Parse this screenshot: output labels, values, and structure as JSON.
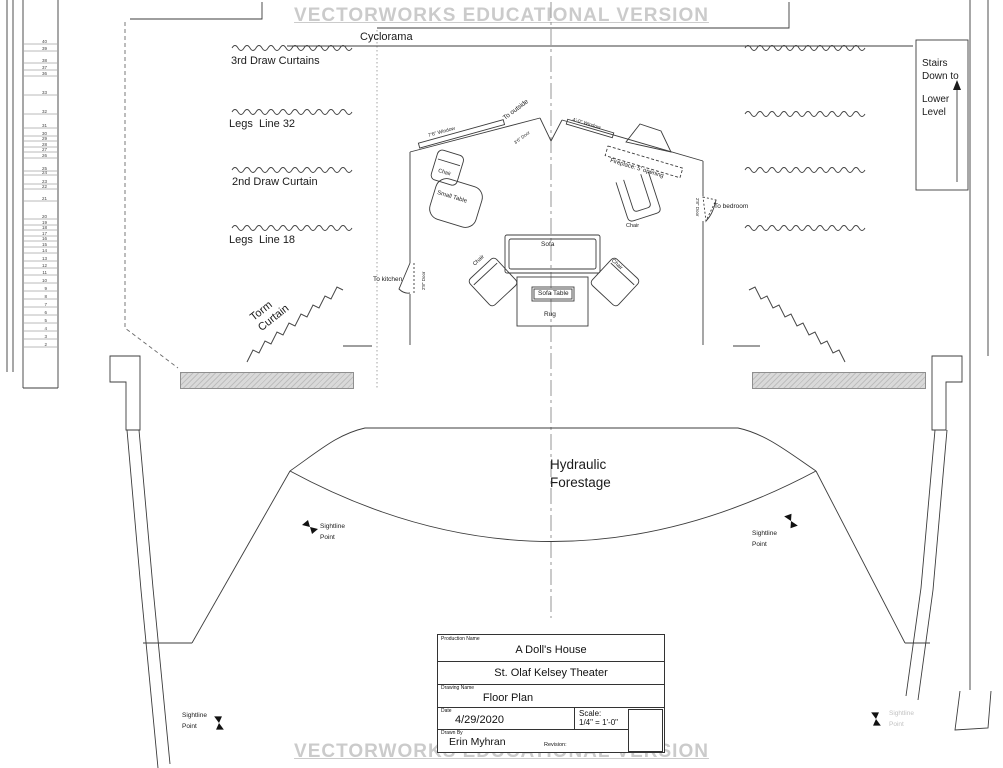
{
  "watermark": {
    "text": "VECTORWORKS EDUCATIONAL VERSION"
  },
  "rigging": {
    "cyclorama": "Cyclorama",
    "third_draw": "3rd Draw Curtains",
    "legs_32": "Legs  Line 32",
    "second_draw": "2nd Draw Curtain",
    "legs_18": "Legs  Line 18",
    "torm_line1": "Torm",
    "torm_line2": "Curtain"
  },
  "fly_rail": {
    "lines": [
      {
        "n": "40",
        "y": 44
      },
      {
        "n": "39",
        "y": 51
      },
      {
        "n": "38",
        "y": 63
      },
      {
        "n": "37",
        "y": 70
      },
      {
        "n": "36",
        "y": 76
      },
      {
        "n": "33",
        "y": 95
      },
      {
        "n": "32",
        "y": 114
      },
      {
        "n": "31",
        "y": 128
      },
      {
        "n": "30",
        "y": 136
      },
      {
        "n": "29",
        "y": 141
      },
      {
        "n": "28",
        "y": 147
      },
      {
        "n": "27",
        "y": 152
      },
      {
        "n": "26",
        "y": 158
      },
      {
        "n": "25",
        "y": 171
      },
      {
        "n": "24",
        "y": 175
      },
      {
        "n": "23",
        "y": 184
      },
      {
        "n": "22",
        "y": 189
      },
      {
        "n": "21",
        "y": 201
      },
      {
        "n": "20",
        "y": 219
      },
      {
        "n": "19",
        "y": 225
      },
      {
        "n": "18",
        "y": 230
      },
      {
        "n": "17",
        "y": 236
      },
      {
        "n": "16",
        "y": 241
      },
      {
        "n": "15",
        "y": 247
      },
      {
        "n": "14",
        "y": 253
      },
      {
        "n": "13",
        "y": 261
      },
      {
        "n": "12",
        "y": 268
      },
      {
        "n": "11",
        "y": 275
      },
      {
        "n": "10",
        "y": 283
      },
      {
        "n": "9",
        "y": 291
      },
      {
        "n": "8",
        "y": 299
      },
      {
        "n": "7",
        "y": 307
      },
      {
        "n": "6",
        "y": 315
      },
      {
        "n": "5",
        "y": 323
      },
      {
        "n": "4",
        "y": 331
      },
      {
        "n": "3",
        "y": 339
      },
      {
        "n": "2",
        "y": 347
      }
    ]
  },
  "stairs": {
    "line1": "Stairs",
    "line2": "Down to",
    "line3": "Lower",
    "line4": "Level"
  },
  "set": {
    "window_left": "7'6\" Window",
    "window_right": "4'-0\" Window",
    "door_outside": "To outside",
    "door_outside_size": "3'6\" Door",
    "door_kitchen": "To kitchen",
    "door_bedroom": "To bedroom",
    "door_size_28": "2'8\" Door",
    "fireplace": "Fireplace: 5' opening",
    "chair": "Chair",
    "small_table": "Small Table",
    "sofa": "Sofa",
    "sofa_table": "Sofa Table",
    "rug": "Rug"
  },
  "forestage": {
    "line1": "Hydraulic",
    "line2": "Forestage"
  },
  "sightline": {
    "line1": "Sightline",
    "line2": "Point"
  },
  "title_block": {
    "production_name_label": "Production Name",
    "production_name": "A Doll's House",
    "theater": "St. Olaf Kelsey Theater",
    "drawing_name_label": "Drawing Name",
    "drawing_name": "Floor Plan",
    "date_label": "Date",
    "date": "4/29/2020",
    "scale_label": "Scale:",
    "scale_value": "1/4\" = 1'-0\"",
    "drawn_by_label": "Drawn By",
    "drawn_by": "Erin Myhran",
    "revision_label": "Revision:"
  }
}
